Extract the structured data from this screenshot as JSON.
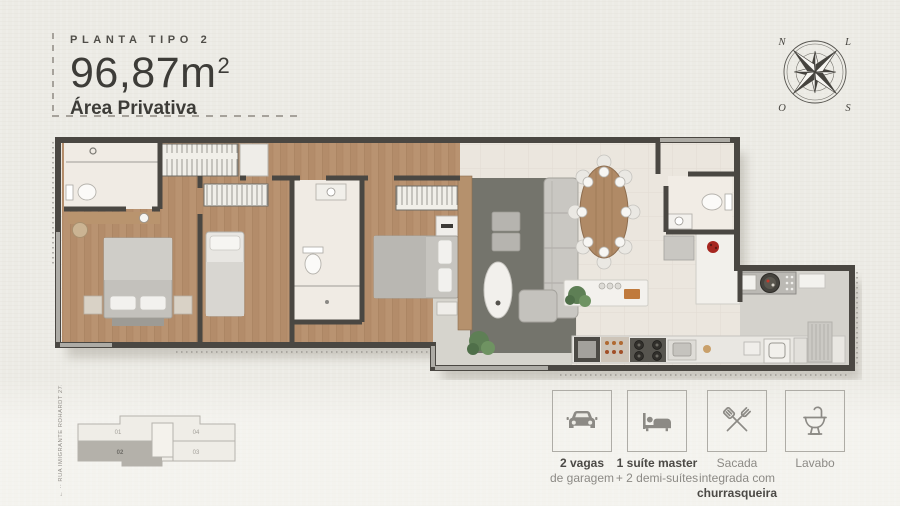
{
  "header": {
    "eyebrow": "PLANTA TIPO 2",
    "area_value": "96,87m",
    "area_sup": "2",
    "subtitle": "Área Privativa"
  },
  "compass": {
    "north": "N",
    "east": "L",
    "south": "S",
    "west": "O"
  },
  "key_plan": {
    "street_label": "← ·· RUA IMIGRANTE ROHARDT 273 ·· →",
    "highlighted_unit": "02",
    "units": [
      {
        "id": "01"
      },
      {
        "id": "04"
      },
      {
        "id": "02"
      },
      {
        "id": "03"
      }
    ]
  },
  "features": [
    {
      "icon": "car-icon",
      "lines": [
        "2 vagas",
        "de garagem"
      ]
    },
    {
      "icon": "bed-icon",
      "lines": [
        "1 suíte master",
        "+ 2 demi-suítes"
      ]
    },
    {
      "icon": "grill-icon",
      "lines": [
        "Sacada",
        "integrada com",
        "churrasqueira"
      ]
    },
    {
      "icon": "washbasin-icon",
      "lines": [
        "Lavabo"
      ]
    }
  ],
  "colors": {
    "background": "#ecebe5",
    "wall": "#4a4742",
    "wood_floor": "#b99371",
    "tile_floor": "#ebe6de",
    "rug": "#74746c",
    "balcony_floor": "#d6d4cd",
    "service_floor": "#d4d2cc",
    "highlight_unit": "#b4b1aa",
    "accent_red": "#a6261f",
    "icon_gray": "#8c8a85",
    "text_dark": "#4b4945"
  }
}
